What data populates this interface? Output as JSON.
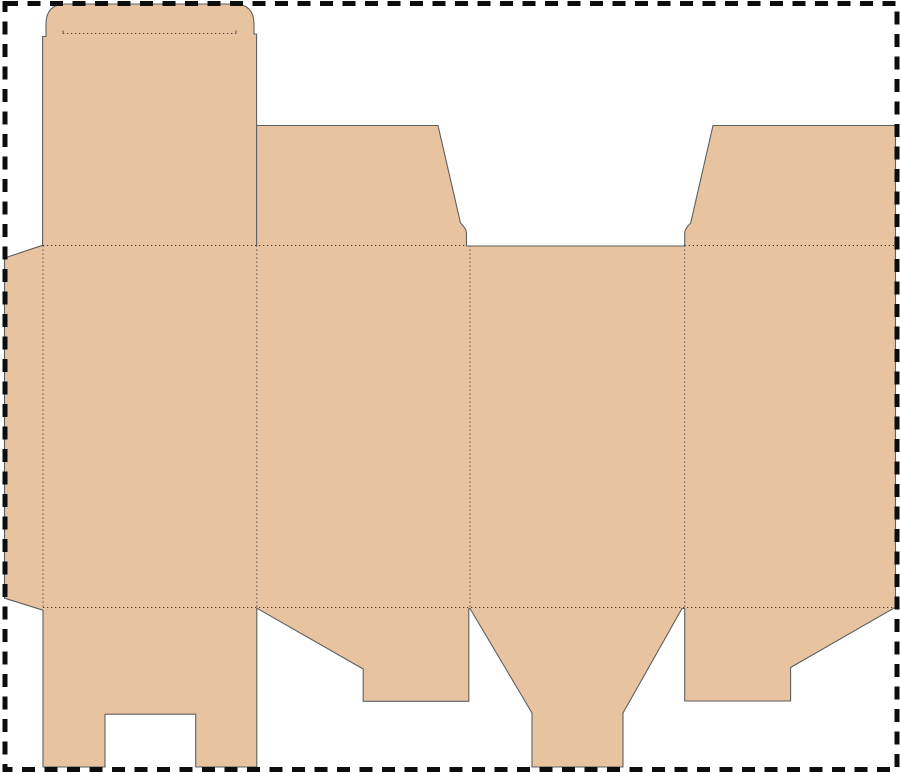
{
  "canvas": {
    "width": 900,
    "height": 773,
    "background": "#ffffff"
  },
  "palette": {
    "board_fill": "#e7c3a0",
    "cut_line": "#5f5f5f",
    "fold_line": "#3e3e3e",
    "page_border": "#0d0d0d"
  },
  "page_border": {
    "x": 5,
    "y": 3.5,
    "width": 892,
    "height": 766,
    "stroke_width": 5,
    "dash": "13 9.5"
  },
  "dieline": {
    "description": "flat box dieline blank",
    "parts": [
      "tuck-tongue",
      "tuck-lid",
      "glue-flap",
      "panel-1",
      "panel-2",
      "panel-3",
      "panel-4",
      "top-dust-flap-left",
      "top-dust-flap-right",
      "bottom-flap-notched",
      "bottom-flap-step-left",
      "bottom-flap-funnel",
      "bottom-flap-step-right"
    ],
    "outline_path": "M 66 4 L 234 4 Q 254 4 254 24 L 254 34 L 256.6 34 L 256.6 125.5 L 438 125.5 L 460.5 223 Q 466.3 228.5 466.5 233 L 466.5 246 L 684.7 246 L 684.7 233 Q 684.9 228.5 690.7 223 L 713 125.5 L 895.5 125.5 L 895.5 607.2 L 790.6 667.5 L 790.6 701 L 684.7 701 L 684.7 608.5 L 682 608.5 L 623 713 L 623 767 L 532 767 L 532 713 L 470 608.5 L 468.8 608.5 L 468.8 701.3 L 363.2 701.3 L 363.2 669 L 256.8 608.2 L 256.8 767 L 195.7 767 L 195.7 714.2 L 105 714.2 L 105 767 L 43 767 L 43 610.2 L 4.5 598.2 L 4.5 258 L 42.6 245.3 L 42.6 36.5 L 46 36.5 L 46 24 Q 46 4 66 4 Z",
    "outline_stroke_width": 1.1,
    "fold_stroke_width": 1,
    "fold_dash": "1.3 2.7",
    "fold_lines": [
      {
        "x1": 43,
        "y1": 245.5,
        "x2": 466.5,
        "y2": 245.5
      },
      {
        "x1": 684.7,
        "y1": 245.5,
        "x2": 895.5,
        "y2": 245.5
      },
      {
        "x1": 43,
        "y1": 607.5,
        "x2": 895.5,
        "y2": 607.5
      },
      {
        "x1": 43,
        "y1": 245.5,
        "x2": 43,
        "y2": 607.5
      },
      {
        "x1": 256.8,
        "y1": 245.5,
        "x2": 256.8,
        "y2": 607.5
      },
      {
        "x1": 470,
        "y1": 245.5,
        "x2": 470,
        "y2": 607.5
      },
      {
        "x1": 684.7,
        "y1": 245.5,
        "x2": 684.7,
        "y2": 607.5
      },
      {
        "x1": 63,
        "y1": 33.5,
        "x2": 236,
        "y2": 33.5
      }
    ],
    "inner_cut_lines": [
      {
        "x1": 256.6,
        "y1": 125.5,
        "x2": 256.6,
        "y2": 246
      },
      {
        "x1": 63,
        "y1": 30.5,
        "x2": 63,
        "y2": 33.5
      },
      {
        "x1": 236,
        "y1": 30.5,
        "x2": 236,
        "y2": 33.5
      }
    ]
  }
}
